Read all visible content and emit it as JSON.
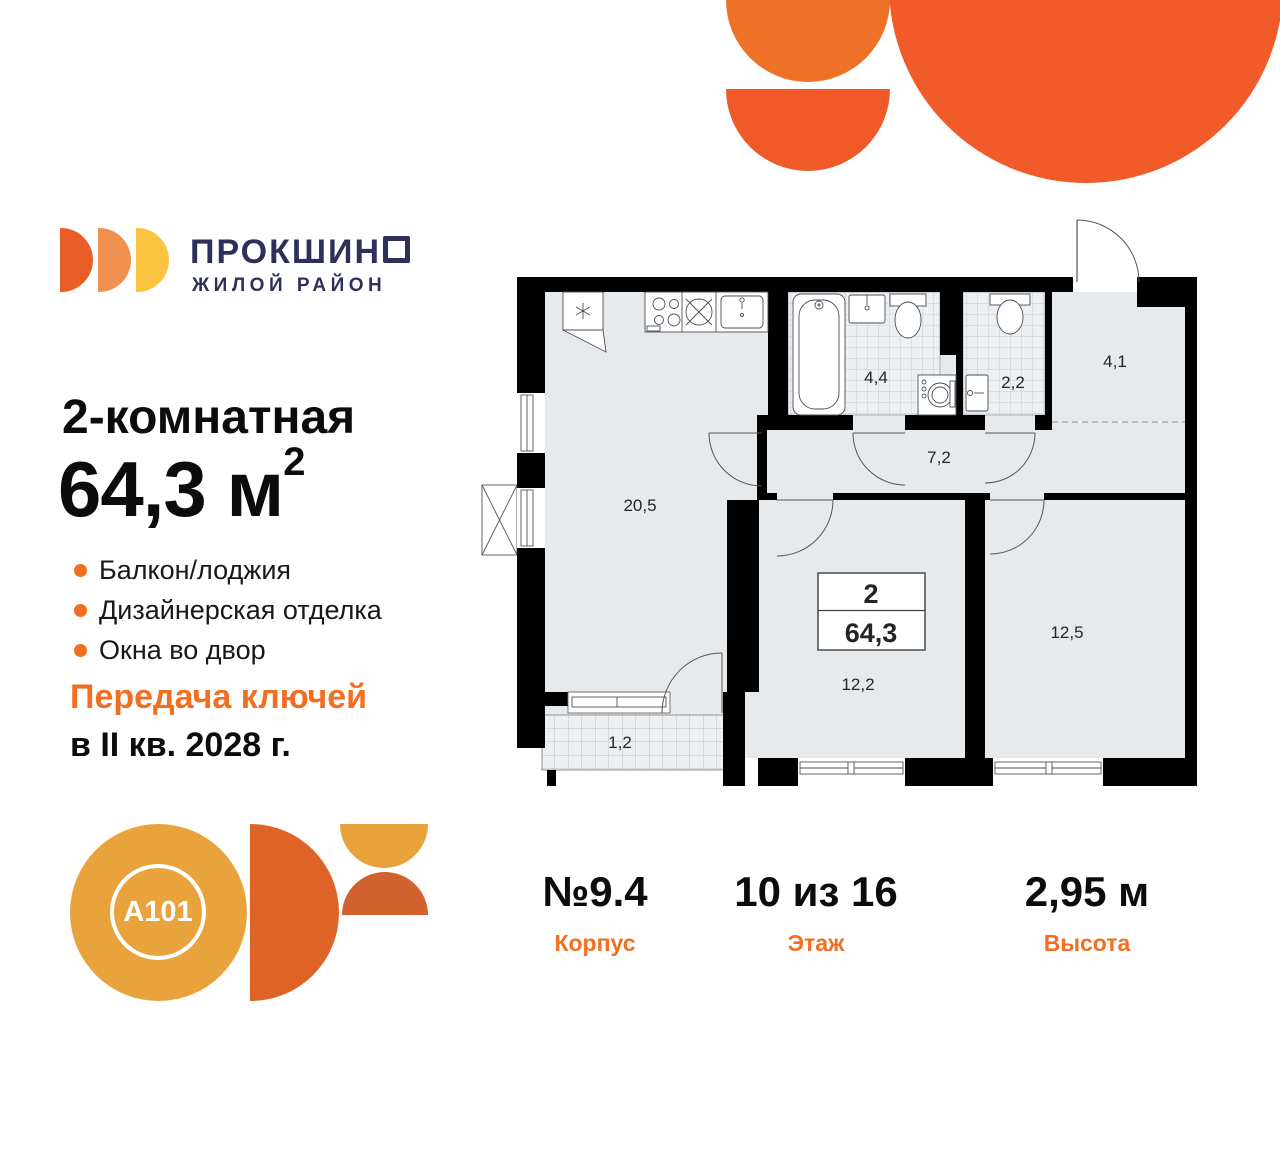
{
  "brand": {
    "title_head": "ПРОКШИН",
    "title_tail": "О",
    "subtitle": "ЖИЛОЙ РАЙОН"
  },
  "listing": {
    "type_title": "2-комнатная",
    "area_value": "64,3 м",
    "area_sup": "2",
    "features": [
      "Балкон/лоджия",
      "Дизайнерская отделка",
      "Окна во двор"
    ],
    "handover_line1": "Передача ключей",
    "handover_line2": "в II кв. 2028 г."
  },
  "developer": {
    "logo_text": "A101"
  },
  "plan": {
    "badge": {
      "rooms": "2",
      "area": "64,3"
    },
    "rooms": [
      {
        "name": "kitchen-living",
        "label": "20,5"
      },
      {
        "name": "bathroom",
        "label": "4,4"
      },
      {
        "name": "wc",
        "label": "2,2"
      },
      {
        "name": "hallway",
        "label": "4,1"
      },
      {
        "name": "corridor",
        "label": "7,2"
      },
      {
        "name": "bedroom-1",
        "label": "12,2"
      },
      {
        "name": "bedroom-2",
        "label": "12,5"
      },
      {
        "name": "balcony",
        "label": "1,2"
      }
    ]
  },
  "summary": [
    {
      "value": "№9.4",
      "label": "Корпус"
    },
    {
      "value": "10 из 16",
      "label": "Этаж"
    },
    {
      "value": "2,95 м",
      "label": "Высота"
    }
  ],
  "colors": {
    "accent": "#F26E21",
    "navy": "#2E2F5B",
    "wall": "#000000",
    "floor": "#E6EAED",
    "deco_small_top": "#ED7127",
    "deco_small_bottom": "#F05A28",
    "deco_big": "#F15A29",
    "a101_circle": "#E8A33C",
    "a101_d": "#DD6327"
  }
}
